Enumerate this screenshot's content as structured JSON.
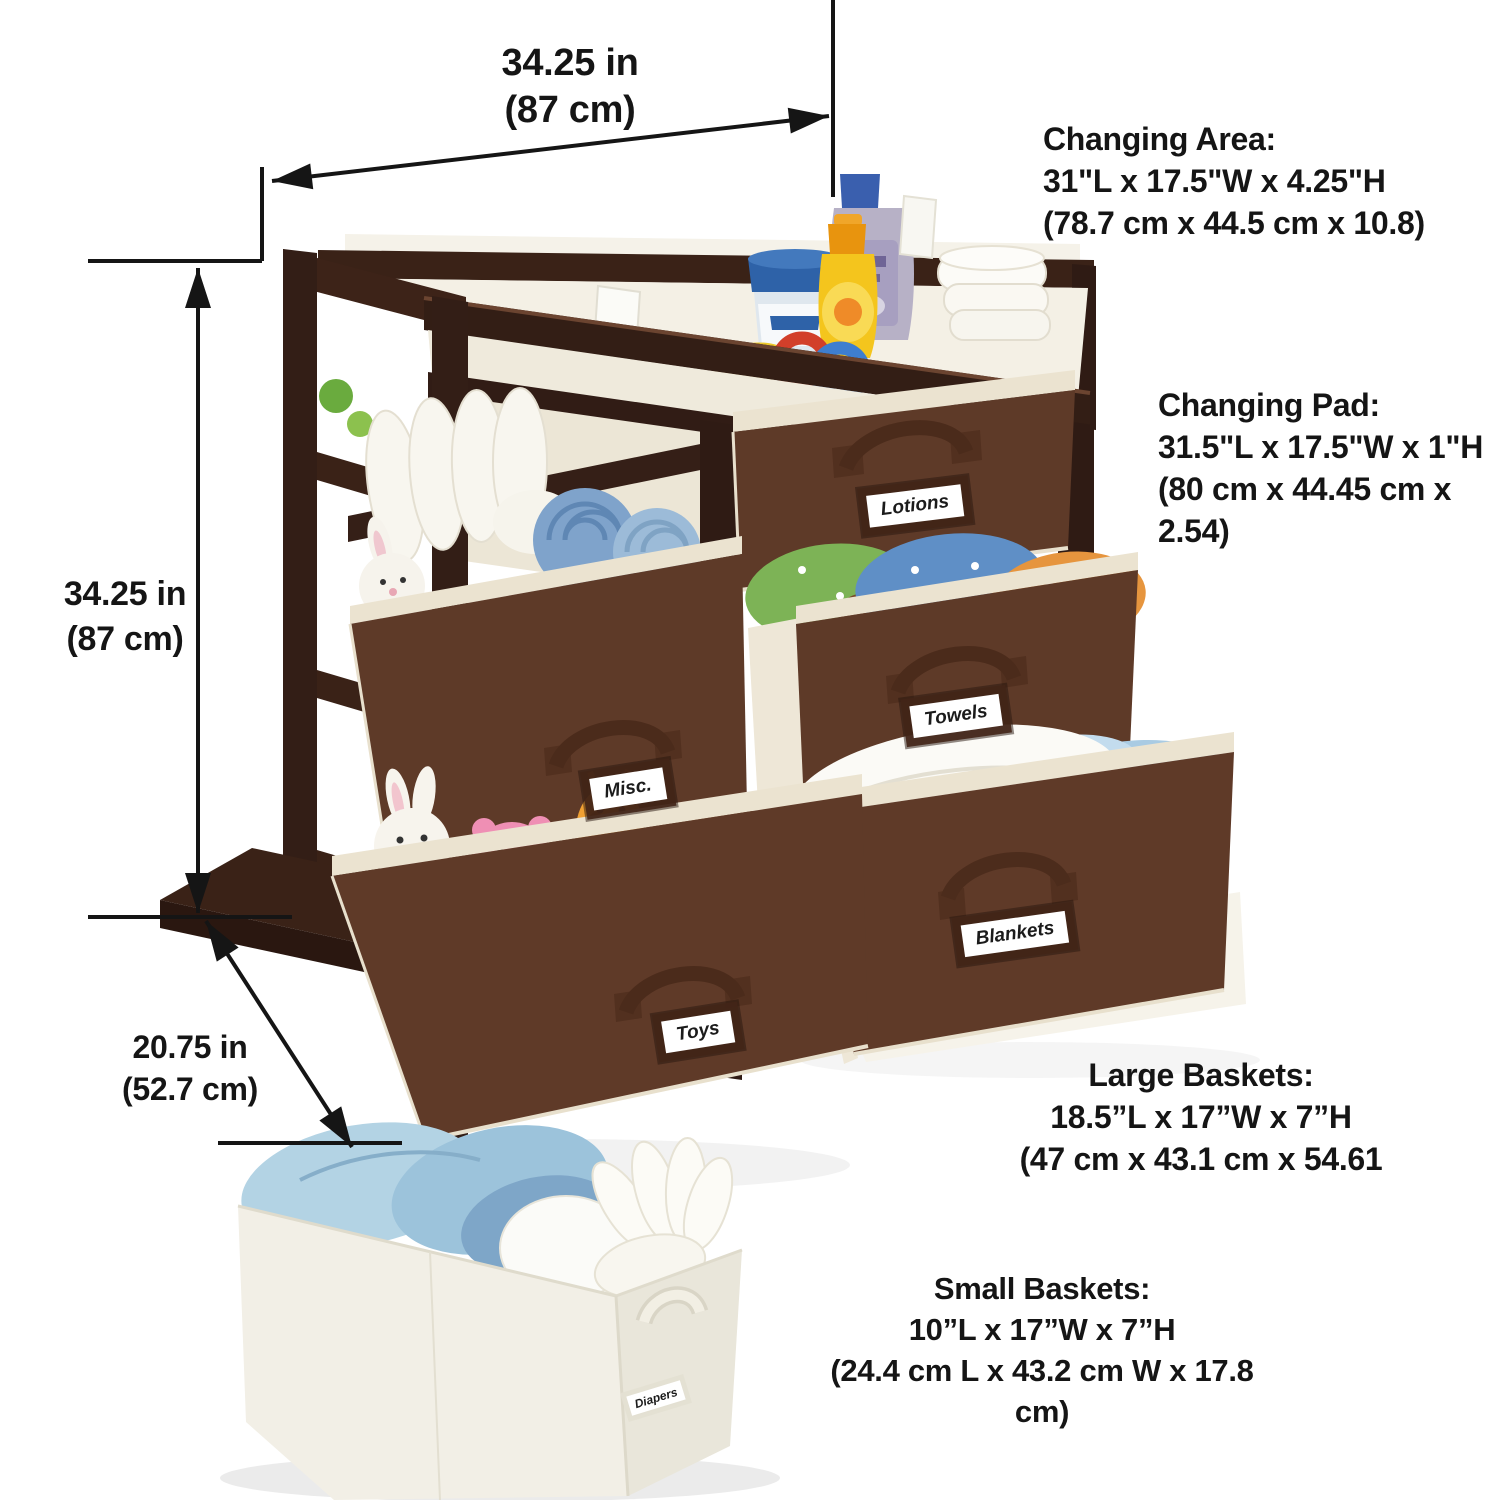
{
  "annotations": {
    "width_top": {
      "value": "34.25 in",
      "metric": "(87 cm)"
    },
    "height_left": {
      "value": "34.25 in",
      "metric": "(87 cm)"
    },
    "depth": {
      "value": "20.75 in",
      "metric": "(52.7 cm)"
    },
    "changing_area": {
      "title": "Changing Area:",
      "imperial": "31\"L x 17.5\"W x 4.25\"H",
      "metric": "(78.7 cm x 44.5 cm x 10.8)"
    },
    "changing_pad": {
      "title": "Changing Pad:",
      "imperial": "31.5\"L x 17.5\"W x 1\"H",
      "metric": "(80 cm x 44.45 cm x 2.54)"
    },
    "large_baskets": {
      "title": "Large Baskets:",
      "imperial": "18.5”L x 17”W x 7”H",
      "metric": "(47 cm x 43.1 cm x 54.61"
    },
    "small_baskets": {
      "title": "Small Baskets:",
      "imperial": "10”L x 17”W x 7”H",
      "metric": "(24.4 cm L x 43.2 cm W x 17.8 cm)"
    }
  },
  "basket_labels": {
    "lotions": "Lotions",
    "towels": "Towels",
    "misc": "Misc.",
    "toys": "Toys",
    "blankets": "Blankets",
    "diapers": "Diapers"
  },
  "colors": {
    "wood": "#2f1b14",
    "basket_brown": "#5e3a28",
    "trim_cream": "#ebe3d0",
    "pad_cream": "#f4f0e5",
    "annotation_text": "#151515",
    "background": "#ffffff"
  }
}
